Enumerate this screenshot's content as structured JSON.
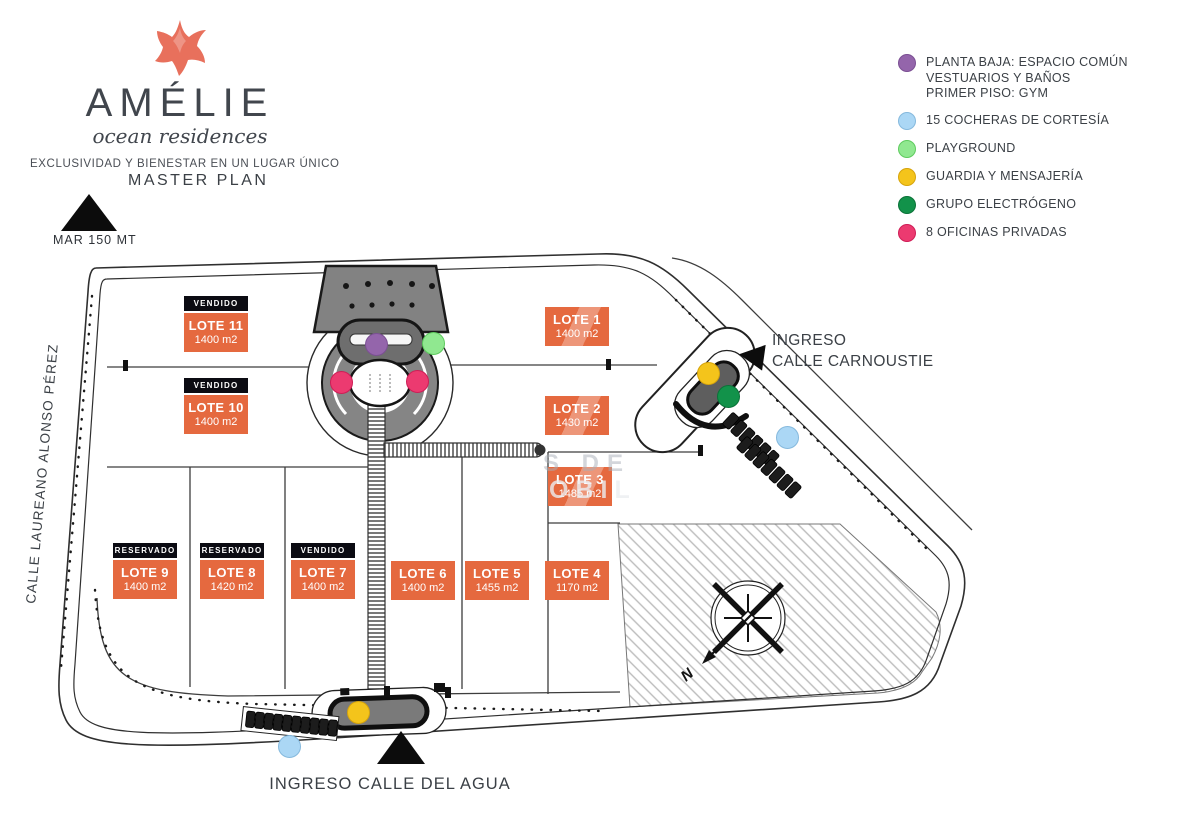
{
  "brand": {
    "name": "AMÉLIE",
    "subtitle": "ocean residences",
    "tagline": "EXCLUSIVIDAD Y BIENESTAR EN UN LUGAR ÚNICO",
    "starfish_color": "#e8705c"
  },
  "title": "MASTER PLAN",
  "sea": {
    "label": "MAR 150 MT"
  },
  "streets": {
    "left": "CALLE LAUREANO ALONSO PÉREZ"
  },
  "entrances": {
    "carnoustie": {
      "line1": "INGRESO",
      "line2": "CALLE CARNOUSTIE"
    },
    "agua": {
      "label": "INGRESO CALLE DEL AGUA"
    }
  },
  "legend": {
    "items": [
      {
        "key": "common",
        "color": "#9465ab",
        "border": "#7b4f93",
        "lines": [
          "PLANTA BAJA: ESPACIO COMÚN",
          "VESTUARIOS Y BAÑOS",
          "PRIMER PISO: GYM"
        ]
      },
      {
        "key": "cocheras",
        "color": "#abd7f5",
        "border": "#85b9dd",
        "lines": [
          "15 COCHERAS DE CORTESÍA"
        ]
      },
      {
        "key": "playground",
        "color": "#90e890",
        "border": "#5ecb5e",
        "lines": [
          "PLAYGROUND"
        ]
      },
      {
        "key": "guardia",
        "color": "#f4c41b",
        "border": "#d6a40c",
        "lines": [
          "GUARDIA Y MENSAJERÍA"
        ]
      },
      {
        "key": "electrogeno",
        "color": "#12924a",
        "border": "#0a7238",
        "lines": [
          "GRUPO ELECTRÓGENO"
        ]
      },
      {
        "key": "oficinas",
        "color": "#ec3a70",
        "border": "#cf1d56",
        "lines": [
          "8 OFICINAS PRIVADAS"
        ]
      }
    ]
  },
  "lots": [
    {
      "id": "1",
      "name": "LOTE 1",
      "area": "1400 m2",
      "status": ""
    },
    {
      "id": "2",
      "name": "LOTE 2",
      "area": "1430 m2",
      "status": ""
    },
    {
      "id": "3",
      "name": "LOTE 3",
      "area": "1485 m2",
      "status": ""
    },
    {
      "id": "4",
      "name": "LOTE 4",
      "area": "1170 m2",
      "status": ""
    },
    {
      "id": "5",
      "name": "LOTE 5",
      "area": "1455 m2",
      "status": ""
    },
    {
      "id": "6",
      "name": "LOTE 6",
      "area": "1400 m2",
      "status": ""
    },
    {
      "id": "7",
      "name": "LOTE 7",
      "area": "1400 m2",
      "status": "VENDIDO"
    },
    {
      "id": "8",
      "name": "LOTE 8",
      "area": "1420 m2",
      "status": "RESERVADO"
    },
    {
      "id": "9",
      "name": "LOTE 9",
      "area": "1400 m2",
      "status": "RESERVADO"
    },
    {
      "id": "10",
      "name": "LOTE 10",
      "area": "1400 m2",
      "status": "VENDIDO"
    },
    {
      "id": "11",
      "name": "LOTE 11",
      "area": "1400 m2",
      "status": "VENDIDO"
    }
  ],
  "colors": {
    "lot_box": "#e5693f",
    "badge_bg": "#0b0b12",
    "text": "#3b4046",
    "line": "#2f2f2f"
  },
  "compass": {
    "north_label": "N"
  },
  "watermark": {
    "fragments": [
      "S DE",
      "OBIL"
    ]
  }
}
